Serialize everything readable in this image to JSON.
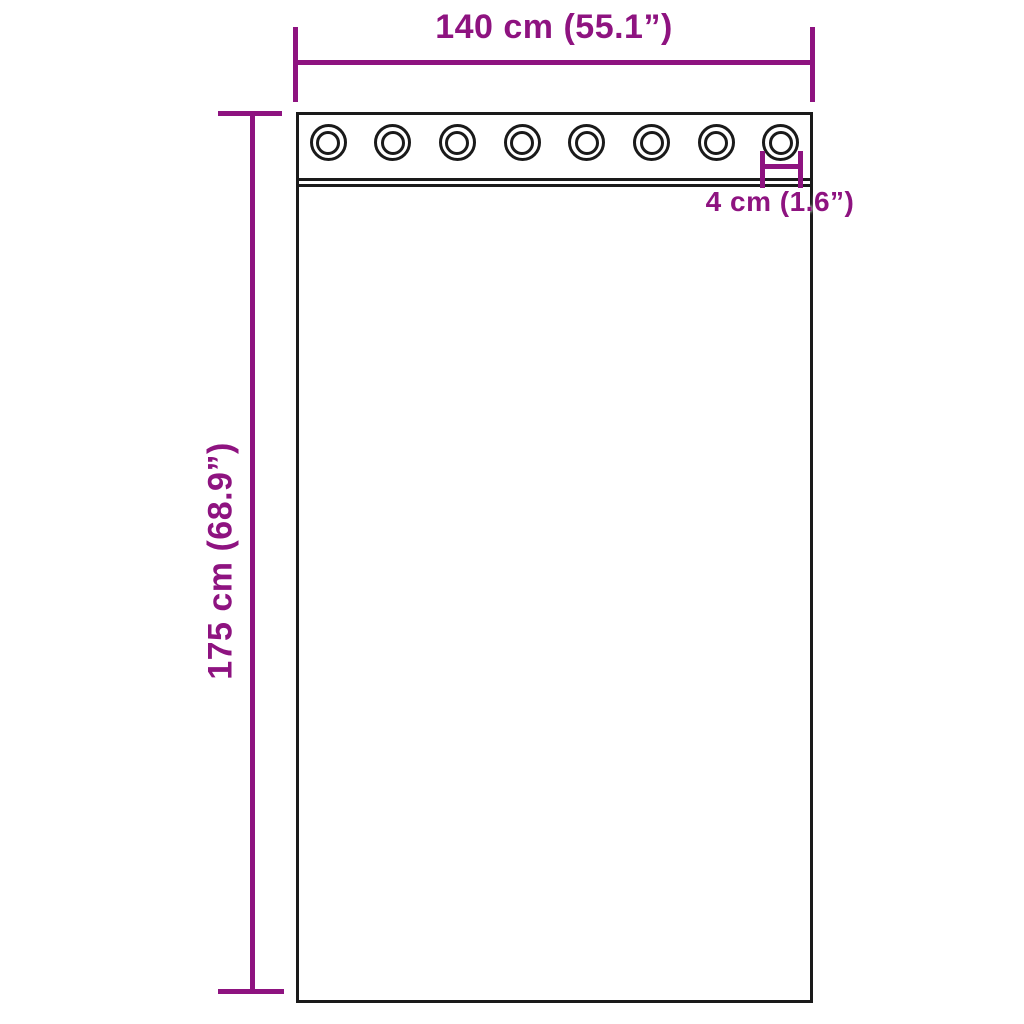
{
  "diagram": {
    "labels": {
      "width": "140 cm (55.1”)",
      "height": "175 cm (68.9”)",
      "grommet_diameter": "4 cm (1.6”)"
    },
    "grommets": {
      "count": 8
    },
    "colors": {
      "dimension": "#8E1380",
      "outline": "#1a1a1a",
      "background": "#ffffff"
    }
  }
}
